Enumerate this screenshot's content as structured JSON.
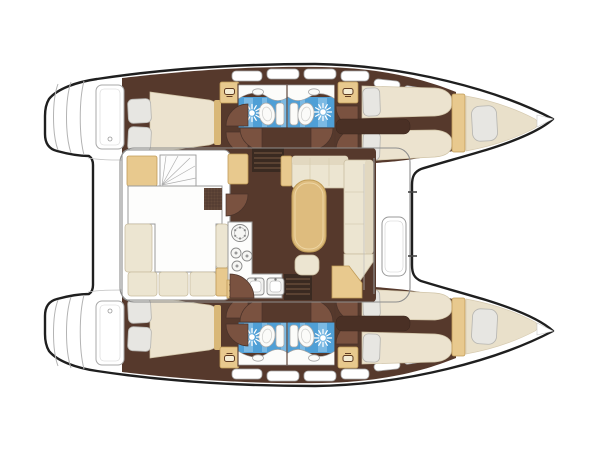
{
  "diagram": {
    "type": "floor-plan",
    "subject": "catamaran interior layout, plan view, bows to the right",
    "hulls": 2,
    "cabins": 4,
    "heads": 4
  },
  "colors": {
    "outline": "#1f1f1f",
    "wall": "#8d8d8d",
    "wall-dark": "#53382c",
    "line-light": "#a9a9a9",
    "floor": "#56392c",
    "floor-dark": "#3a2a21",
    "tread": "#6e513d",
    "door": "#7a5240",
    "bed": "#ece3cf",
    "pillow": "#e7e6e2",
    "sofa": "#ece5d1",
    "sofa-back": "#e2d8c0",
    "tan": "#e8c98e",
    "tan-dark": "#d9b878",
    "table": "#debc7e",
    "tile": "#4f9fd6",
    "tile-light": "#93c8ea",
    "counter": "#fdfdfc",
    "grille": "#63493a",
    "bow-cushion": "#e9e0ca"
  },
  "icons": {
    "shower-sun-icon": "white radial sunburst on blue shower tile",
    "toilet-icon": "white bowl ellipse with cistern rectangle",
    "washbasin-icon": "small oval basin on white counter",
    "vanity-sink-icon": "tiny dark basin glyph on tan cabinet",
    "stove-burner-icon": "concentric circles with dots",
    "galley-sink-icon": "double rounded squares with tap dot",
    "companionway-steps-icon": "dark rectangle with parallel treads",
    "door-swing-icon": "quarter-circle wedge",
    "stair-fan-icon": "fan of radiating tread lines"
  }
}
